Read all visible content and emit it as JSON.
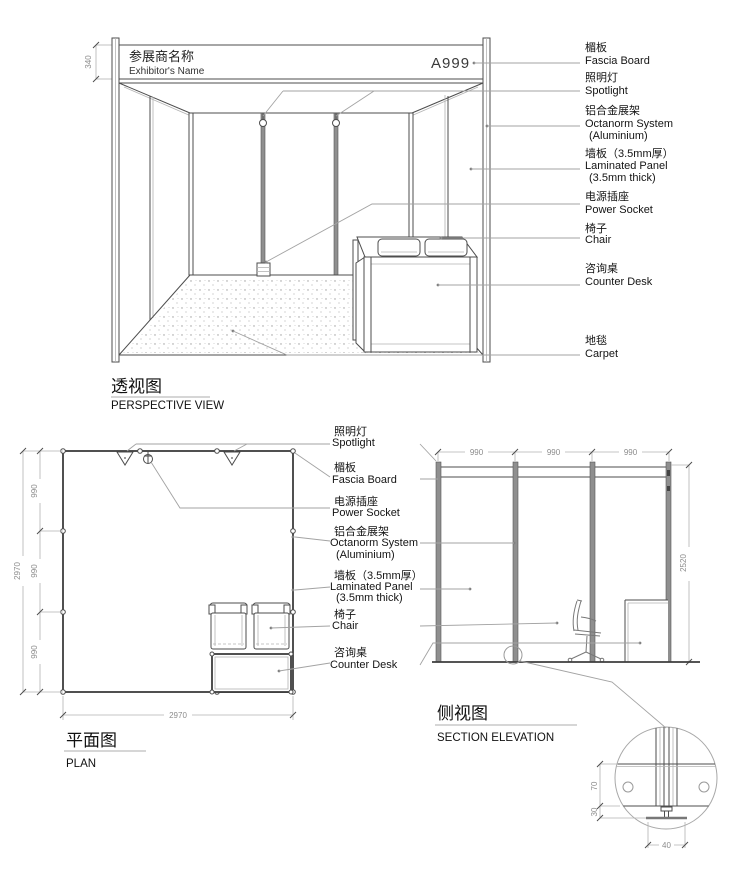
{
  "views": {
    "perspective": {
      "title_cn": "透视图",
      "title_en": "PERSPECTIVE VIEW"
    },
    "plan": {
      "title_cn": "平面图",
      "title_en": "PLAN"
    },
    "elevation": {
      "title_cn": "侧视图",
      "title_en": "SECTION ELEVATION"
    }
  },
  "fascia": {
    "exhibitor_cn": "参展商名称",
    "exhibitor_en": "Exhibitor's Name",
    "booth_number": "A999"
  },
  "labels": {
    "fascia_cn": "楣板",
    "fascia_en": "Fascia Board",
    "spotlight_cn": "照明灯",
    "spotlight_en": "Spotlight",
    "octanorm_cn": "铝合金展架",
    "octanorm_en1": "Octanorm System",
    "octanorm_en2": "(Aluminium)",
    "panel_cn": "墙板（3.5mm厚）",
    "panel_en1": "Laminated Panel",
    "panel_en2": "(3.5mm thick)",
    "socket_cn": "电源插座",
    "socket_en": "Power Socket",
    "chair_cn": "椅子",
    "chair_en": "Chair",
    "desk_cn": "咨询桌",
    "desk_en": "Counter Desk",
    "carpet_cn": "地毯",
    "carpet_en": "Carpet"
  },
  "dims": {
    "fascia_height": "340",
    "bay": "990",
    "booth_size": "2970",
    "wall_height": "2520",
    "detail_upper": "70",
    "detail_lower": "30",
    "detail_foot": "40"
  },
  "colors": {
    "line": "#4d4d4d",
    "leader": "#a3a3a3",
    "dim_text": "#8c8c8c",
    "text": "#141414"
  }
}
